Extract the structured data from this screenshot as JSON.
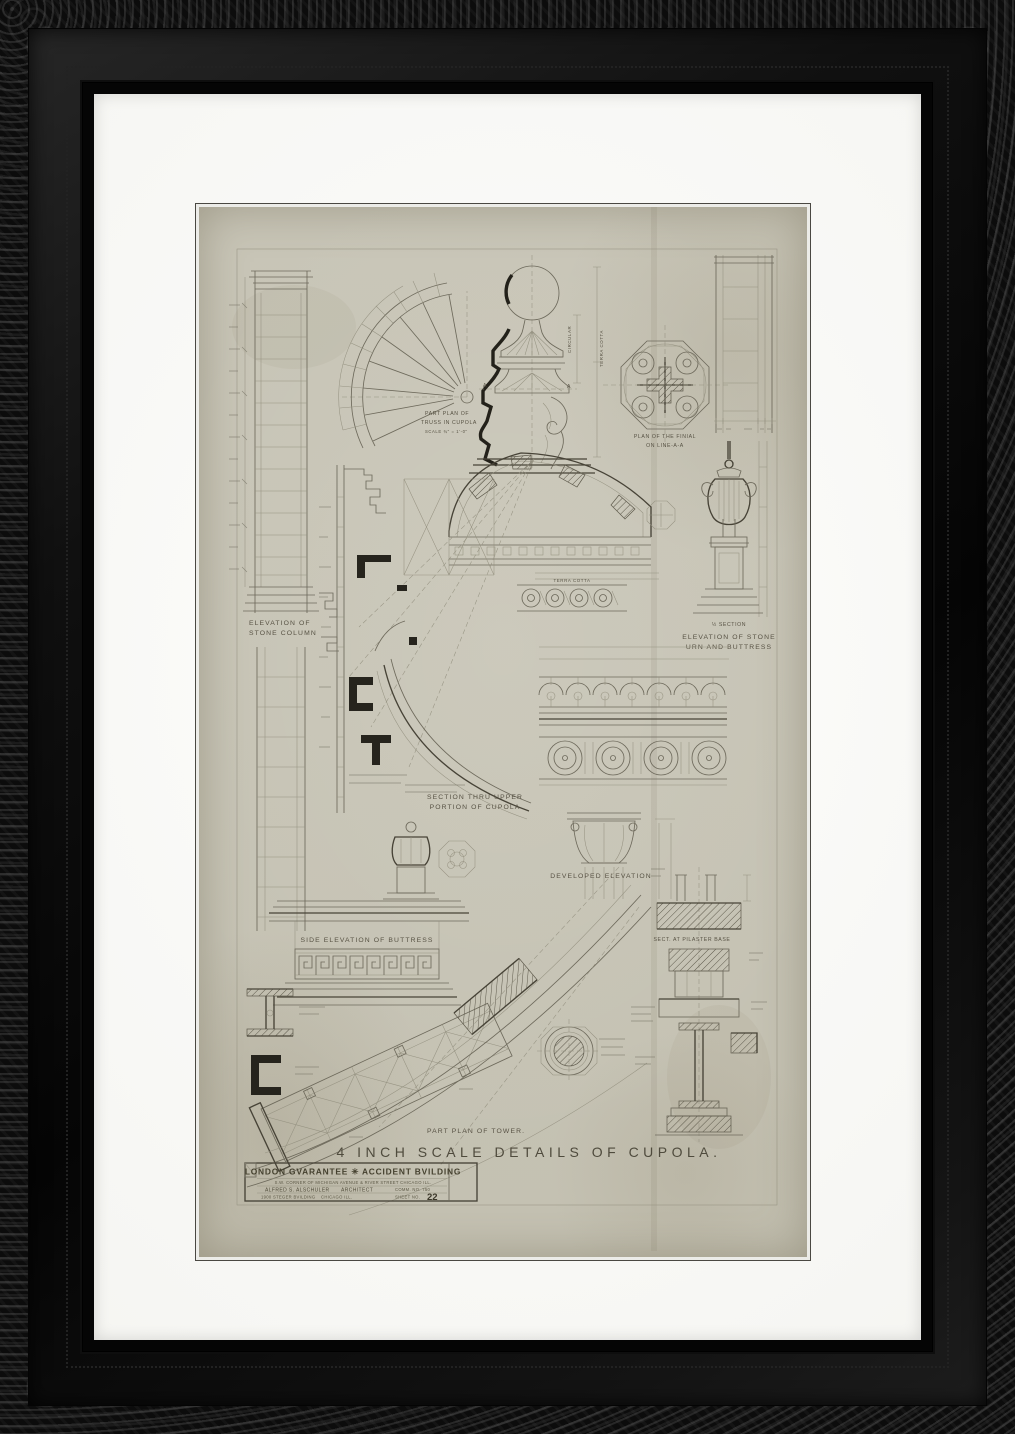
{
  "palette": {
    "frame_black": "#0c0c0c",
    "mat_white": "#fbfbf8",
    "paper": "#c8c5b7",
    "pencil": "#6e6a5c",
    "ink_bold": "#23211a"
  },
  "sheet": {
    "main_title": "4 INCH SCALE DETAILS OF CUPOLA.",
    "labels": {
      "part_plan_truss_line1": "PART PLAN OF",
      "part_plan_truss_line2": "TRUSS IN CUPOLA",
      "part_plan_truss_scale": "SCALE ¾\" = 1'-0\"",
      "plan_finial_line1": "PLAN OF THE FINIAL",
      "plan_finial_line2": "ON LINE-A-A",
      "elev_column_line1": "ELEVATION OF",
      "elev_column_line2": "STONE COLUMN",
      "half_section": "½ SECTION",
      "elev_urn_line1": "ELEVATION OF STONE",
      "elev_urn_line2": "URN AND BUTTRESS",
      "section_upper_line1": "SECTION THRU UPPER",
      "section_upper_line2": "PORTION OF CUPOLA",
      "developed_elevation": "DEVELOPED ELEVATION",
      "side_elev_buttress": "SIDE ELEVATION OF BUTTRESS",
      "sect_pilaster_base": "SECT. AT PILASTER BASE",
      "part_plan_tower": "PART PLAN OF TOWER.",
      "terra_cotta": "TERRA COTTA",
      "circular": "CIRCULAR",
      "mark_a_left": "A",
      "mark_a_right": "A"
    },
    "title_block": {
      "building": "LONDON GVARANTEE ✳ ACCIDENT BVILDING",
      "address": "S.W. CORNER OF MICHIGAN AVENUE & RIVER STREET CHICAGO ILL.",
      "architect": "ALFRED S. ALSCHULER",
      "architect_title": "ARCHITECT",
      "commission": "COMM. NO. 750",
      "office": "1900 STEGER BVILDING",
      "office_city": "CHICAGO ILL.",
      "sheet_label": "SHEET NO.",
      "sheet_number": "22"
    }
  }
}
